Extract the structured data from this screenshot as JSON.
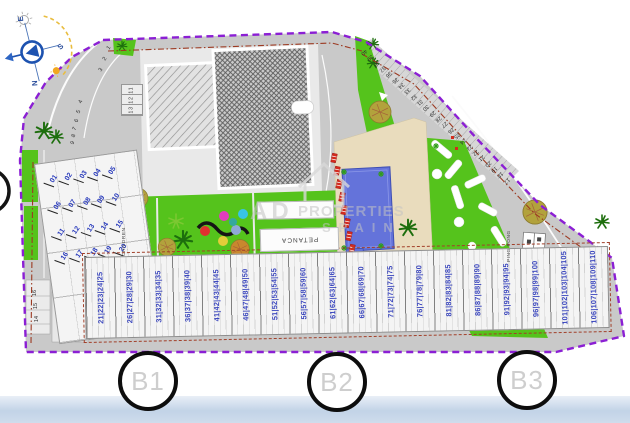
{
  "title": "Residential development site plan",
  "compass": {
    "top": "E",
    "right": "S",
    "bottom": "N"
  },
  "watermark": {
    "brand": "AD",
    "line1": "PROPERTIES",
    "line2": "SPAIN"
  },
  "labels": {
    "petanca": "PETANCA",
    "ping_pong": "PING PONG",
    "children": "CHILDREN"
  },
  "grid_bubbles": [
    "B1",
    "B2",
    "B3"
  ],
  "parking": {
    "curve_top": [
      "1",
      "2",
      "3"
    ],
    "curve_left": [
      "4",
      "5",
      "6",
      "7",
      "8",
      "9"
    ],
    "left_edge": [
      "16",
      "15",
      "14"
    ],
    "block_label": "13 12 11",
    "diagonal": [
      "40",
      "39",
      "38",
      "37",
      "36",
      "35",
      "34",
      "33",
      "32",
      "31",
      "30",
      "29",
      "28",
      "27",
      "26",
      "25",
      "24",
      "23",
      "22",
      "21",
      "20",
      "19",
      "18",
      "17"
    ]
  },
  "units": {
    "rows": [
      [
        "01",
        "02",
        "03",
        "04",
        "05"
      ],
      [
        "06",
        "07",
        "08",
        "09",
        "10"
      ],
      [
        "11",
        "12",
        "13",
        "14",
        "15"
      ],
      [
        "16",
        "17",
        "18",
        "19",
        "20"
      ]
    ]
  },
  "garages": {
    "groups": [
      "21|22|23|24|25",
      "26|27|28|29|30",
      "31|32|33|34|35",
      "36|37|38|39|40",
      "41|42|43|44|45",
      "46|47|48|49|50",
      "51|52|53|54|55",
      "56|57|58|59|60",
      "61|62|63|64|65",
      "66|67|68|69|70",
      "71|72|73|74|75",
      "76|77|78|79|80",
      "81|82|83|84|85",
      "86|87|88|89|90",
      "91|92|93|94|95",
      "96|97|98|99|100",
      "101|102|103|104|105",
      "106|107|108|109|110"
    ]
  },
  "colors": {
    "boundary_purple": "#8b1fd4",
    "setback_red": "#a2402a",
    "green": "#55c31c",
    "pool_blue": "#6473da",
    "deck_beige": "#e9dcbd",
    "lounger_red": "#d32b1e",
    "number_blue": "#3945bd",
    "footer_blue": "#c2d3e7"
  }
}
